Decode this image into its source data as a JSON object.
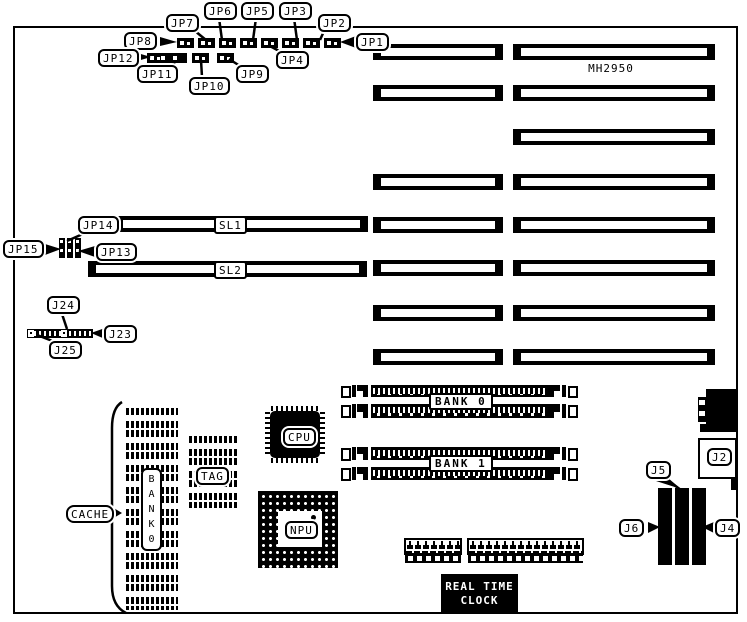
{
  "board": {
    "model": "MH2950"
  },
  "slots": {
    "sl1": "SL1",
    "sl2": "SL2"
  },
  "jumpers": {
    "jp1": "JP1",
    "jp2": "JP2",
    "jp3": "JP3",
    "jp4": "JP4",
    "jp5": "JP5",
    "jp6": "JP6",
    "jp7": "JP7",
    "jp8": "JP8",
    "jp9": "JP9",
    "jp10": "JP10",
    "jp11": "JP11",
    "jp12": "JP12",
    "jp13": "JP13",
    "jp14": "JP14",
    "jp15": "JP15"
  },
  "connectors": {
    "j2": "J2",
    "j4": "J4",
    "j5": "J5",
    "j6": "J6",
    "j23": "J23",
    "j24": "J24",
    "j25": "J25"
  },
  "memory": {
    "bank0": "BANK 0",
    "bank1": "BANK 1",
    "cache_bank_vertical": "BANK0"
  },
  "chips": {
    "cpu": "CPU",
    "npu": "NPU",
    "tag": "TAG",
    "cache": "CACHE"
  },
  "rtc": {
    "line1": "REAL TIME",
    "line2": "CLOCK"
  }
}
